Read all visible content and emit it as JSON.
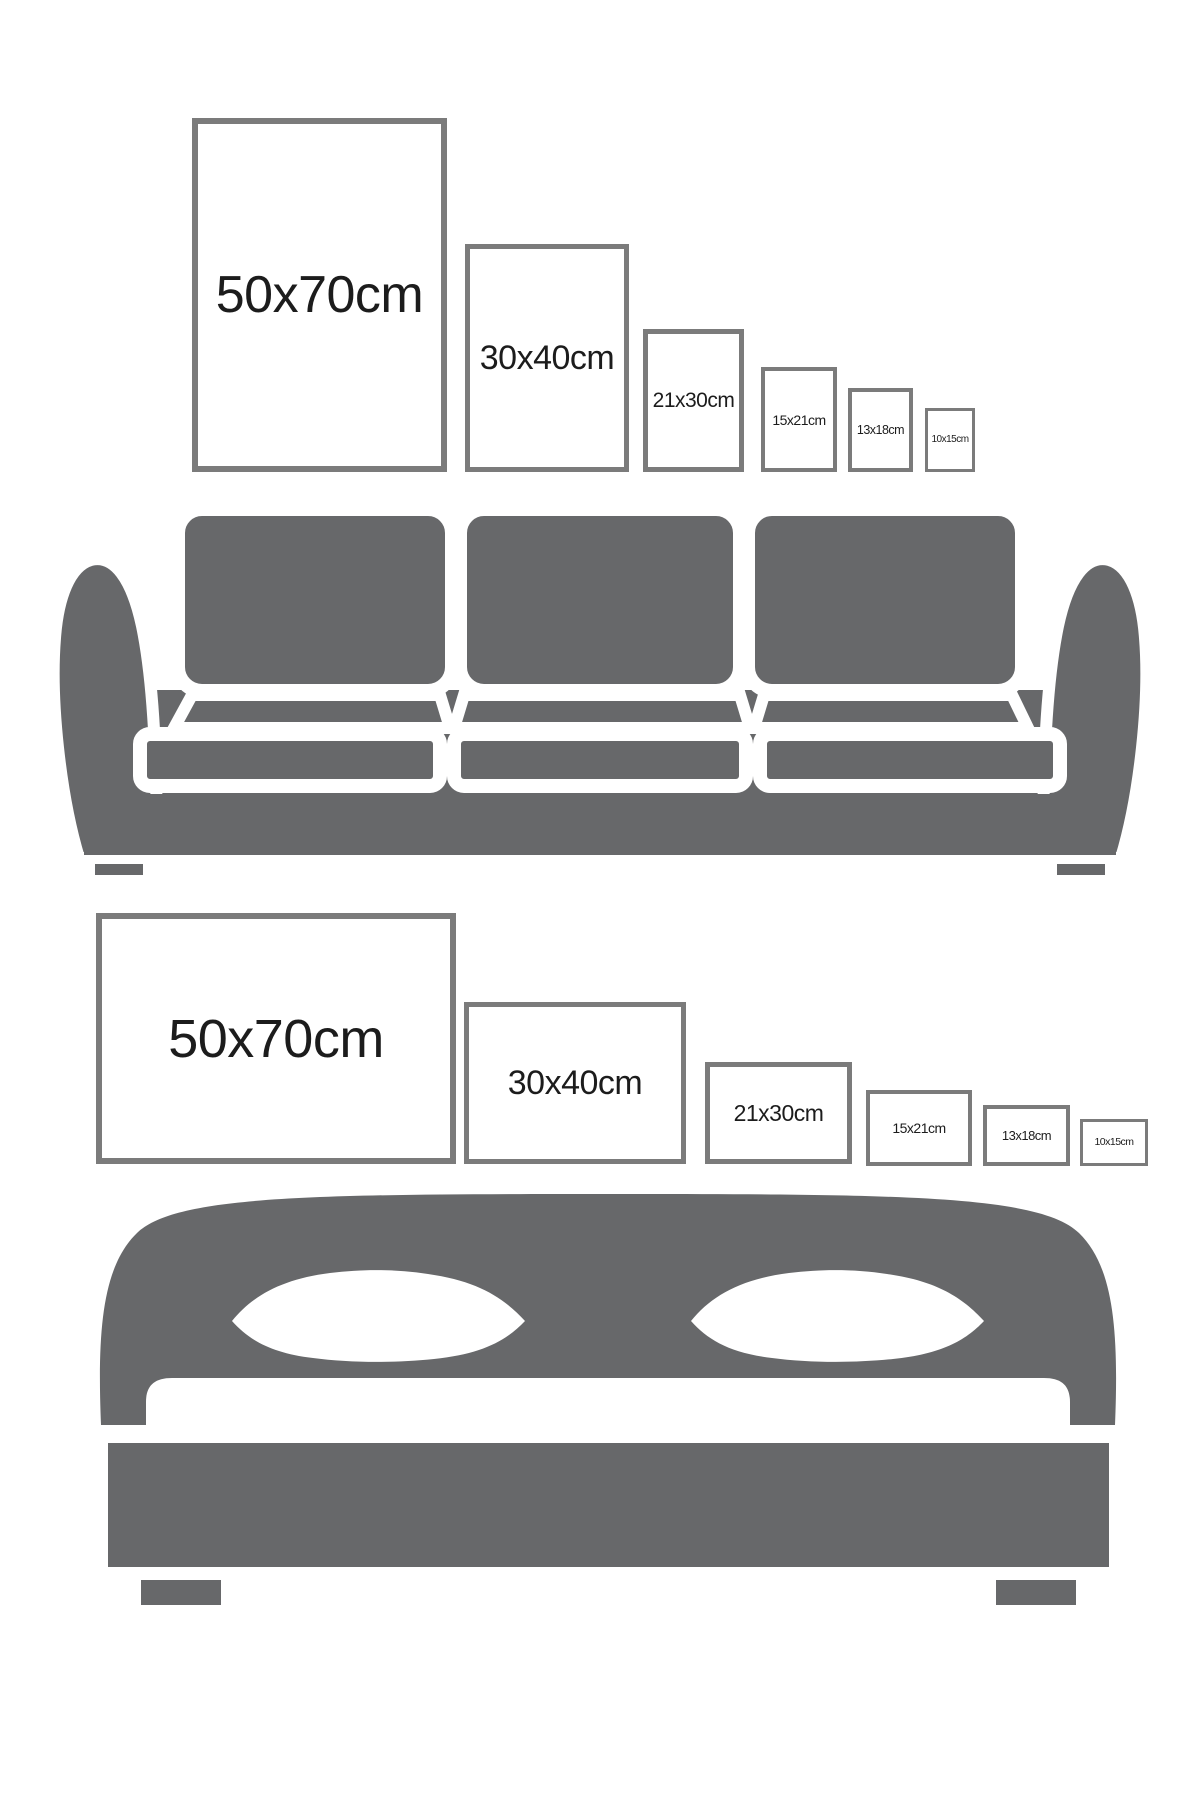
{
  "page": {
    "background": "#ffffff",
    "description": "Poster frame size comparison infographic: portrait frames above a sofa, landscape frames above a bed"
  },
  "colors": {
    "furniture_gray": "#67686a",
    "frame_border": "#7b7b7b",
    "label_text": "#1c1c1c",
    "cutout_white": "#ffffff"
  },
  "portrait_row": {
    "orientation": "portrait",
    "sizes": [
      {
        "label": "50x70cm"
      },
      {
        "label": "30x40cm"
      },
      {
        "label": "21x30cm"
      },
      {
        "label": "15x21cm"
      },
      {
        "label": "13x18cm"
      },
      {
        "label": "10x15cm"
      }
    ]
  },
  "landscape_row": {
    "orientation": "landscape",
    "sizes": [
      {
        "label": "50x70cm"
      },
      {
        "label": "30x40cm"
      },
      {
        "label": "21x30cm"
      },
      {
        "label": "15x21cm"
      },
      {
        "label": "13x18cm"
      },
      {
        "label": "10x15cm"
      }
    ]
  },
  "illustrations": {
    "sofa": "three-seat-sofa-silhouette",
    "bed": "double-bed-silhouette"
  }
}
